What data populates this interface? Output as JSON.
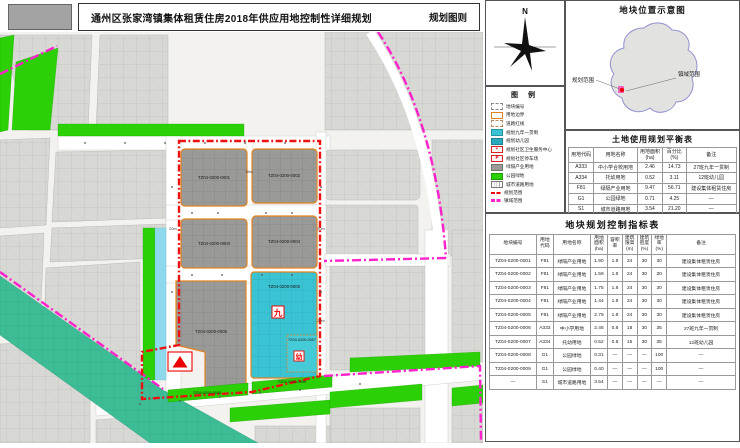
{
  "title_bar": {
    "title": "通州区张家湾镇集体租赁住房2018年供应用地控制性详细规划",
    "sheet_label": "规划图则"
  },
  "compass": {
    "north_label": "N"
  },
  "legend": {
    "title": "图  例",
    "items": [
      {
        "label": "地块编号",
        "swatch": "plot-number"
      },
      {
        "label": "用地边界",
        "swatch": "orange-line"
      },
      {
        "label": "道路红线",
        "swatch": "dash-box"
      },
      {
        "label": "规划九年一贯制",
        "swatch": "cyan"
      },
      {
        "label": "规划幼儿园",
        "swatch": "teal"
      },
      {
        "label": "规划社区卫生服务中心",
        "swatch": "red-cross",
        "glyph": "+"
      },
      {
        "label": "规划社区停车场",
        "swatch": "red-p",
        "glyph": "P"
      },
      {
        "label": "绿隔产业用地",
        "swatch": "gray"
      },
      {
        "label": "公园绿地",
        "swatch": "green"
      },
      {
        "label": "城市道路用地",
        "swatch": "road"
      },
      {
        "label": "规划范围",
        "swatch": "red-dash"
      },
      {
        "label": "镇域范围",
        "swatch": "magenta-dash"
      }
    ]
  },
  "location_map": {
    "title": "地块位置示意图",
    "planning_scope_label": "规划范围",
    "town_scope_label": "镇域范围"
  },
  "balance_table": {
    "title": "土地使用规划平衡表",
    "headers": [
      "用地代码",
      "用地名称",
      "用地面积(ha)",
      "百分比(%)",
      "备注"
    ],
    "rows": [
      {
        "cells": [
          "A333",
          "中小学合校用地",
          "2.46",
          "14.73",
          "27班九年一贯制"
        ]
      },
      {
        "cells": [
          "A334",
          "托幼用地",
          "0.52",
          "3.11",
          "12班幼儿园"
        ]
      },
      {
        "cells": [
          "F81",
          "绿隔产业用地",
          "9.47",
          "56.71",
          "建设集体租赁住房"
        ]
      },
      {
        "cells": [
          "G1",
          "公园绿地",
          "0.71",
          "4.25",
          "—"
        ]
      },
      {
        "cells": [
          "S1",
          "城市道路用地",
          "3.54",
          "21.20",
          "—"
        ]
      }
    ],
    "total_row": {
      "label": "地块规划范围",
      "cells": [
        "16.70",
        "100.00",
        "—"
      ]
    }
  },
  "indicator_table": {
    "title": "地块规划控制指标表",
    "headers": [
      "地块编号",
      "用地\n代码",
      "用地名称",
      "用地\n面积\n(ha)",
      "容积\n率",
      "建筑\n限高\n(m)",
      "建筑\n密度\n(%)",
      "绿地\n率\n(%)",
      "备注"
    ],
    "rows": [
      [
        "TZ04-0200-0001",
        "F81",
        "绿隔产业用地",
        "1.90",
        "1.8",
        "24",
        "30",
        "30",
        "建设集体租赁住房"
      ],
      [
        "TZ04-0200-0002",
        "F81",
        "绿隔产业用地",
        "1.59",
        "1.8",
        "24",
        "30",
        "30",
        "建设集体租赁住房"
      ],
      [
        "TZ04-0200-0003",
        "F81",
        "绿隔产业用地",
        "1.75",
        "1.8",
        "24",
        "30",
        "30",
        "建设集体租赁住房"
      ],
      [
        "TZ04-0200-0004",
        "F81",
        "绿隔产业用地",
        "1.44",
        "1.8",
        "24",
        "30",
        "30",
        "建设集体租赁住房"
      ],
      [
        "TZ04-0200-0005",
        "F81",
        "绿隔产业用地",
        "2.79",
        "1.8",
        "24",
        "30",
        "30",
        "建设集体租赁住房"
      ],
      [
        "TZ04-0200-0006",
        "A333",
        "中小学用地",
        "2.46",
        "0.8",
        "18",
        "30",
        "35",
        "27班九年一贯制"
      ],
      [
        "TZ04-0200-0007",
        "A334",
        "托幼用地",
        "0.52",
        "0.8",
        "15",
        "30",
        "35",
        "12班幼儿园"
      ],
      [
        "TZ04-0200-0008",
        "G1",
        "公园绿地",
        "0.31",
        "—",
        "—",
        "—",
        "100",
        "—"
      ],
      [
        "TZ04-0200-0009",
        "G1",
        "公园绿地",
        "0.40",
        "—",
        "—",
        "—",
        "100",
        "—"
      ],
      [
        "—",
        "S1",
        "城市道路用地",
        "3.54",
        "—",
        "—",
        "—",
        "—",
        "—"
      ]
    ]
  },
  "map": {
    "plots": [
      {
        "id": "TZ04-0200-0001"
      },
      {
        "id": "TZ04-0200-0002"
      },
      {
        "id": "TZ04-0200-0003"
      },
      {
        "id": "TZ04-0200-0004"
      },
      {
        "id": "TZ04-0200-0005"
      },
      {
        "id": "TZ04-0200-0006"
      },
      {
        "id": "TZ04-0200-0007"
      },
      {
        "id": "TZ04-0200-0008"
      },
      {
        "id": "TZ04-0200-0009"
      }
    ],
    "symbols": {
      "school": "九",
      "kindergarten": "幼"
    },
    "road_width_labels": [
      "15m",
      "20m",
      "20m",
      "20m"
    ]
  },
  "colors": {
    "boundary_red": "#ee1111",
    "town_boundary_magenta": "#ff22cc",
    "industry_gray": "#9a9a98",
    "education_cyan": "#3ac3d3",
    "park_green": "#2bd006",
    "plot_border_orange": "#e2821f",
    "greenway_teal": "#3dbd96",
    "canal_cyan": "#8ed9ec"
  }
}
